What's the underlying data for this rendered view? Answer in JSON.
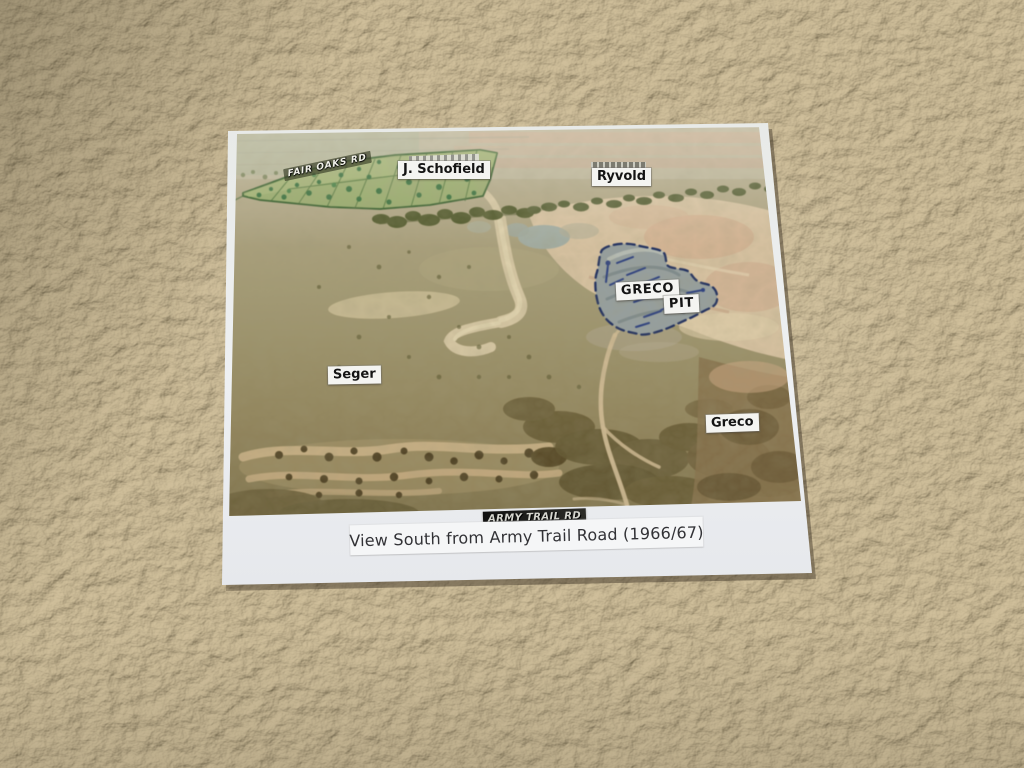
{
  "scene": {
    "description": "Printed annotated aerial photograph lying on a beige carpet",
    "carpet_color": "#b4a78b",
    "paper_color": "#eceef0"
  },
  "card": {
    "caption": "View South from Army Trail Road (1966/67)",
    "labels": {
      "fair_oaks_rd": "FAIR OAKS RD",
      "j_schofield": "J. Schofield",
      "ryvold": "Ryvold",
      "greco": "GRECO",
      "pit": "PIT",
      "seger": "Seger",
      "greco_farm": "Greco",
      "army_trail_rd": "ARMY TRAIL RD"
    },
    "annotation_colors": {
      "wooded_parcel_green": "#2c5a22",
      "pit_outline_navy": "#1d2e63",
      "pit_fill_gray": "#96a09f",
      "label_text": "#141414",
      "label_background": "#f4f4f1"
    }
  }
}
